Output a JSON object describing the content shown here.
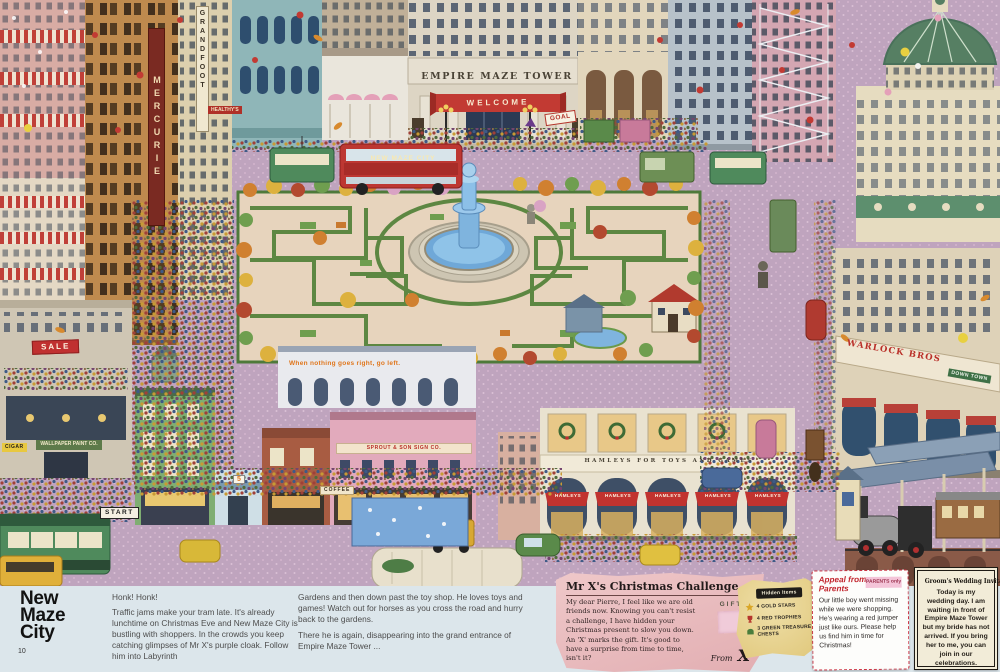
{
  "page": {
    "number": "10",
    "title_lines": [
      "New",
      "Maze",
      "City"
    ]
  },
  "intro": {
    "exclaim": "Honk! Honk!",
    "para1": "Traffic jams make your tram late. It's already lunchtime on Christmas Eve and New Maze City is bustling with shoppers. In the crowds you keep catching glimpses of Mr X's purple cloak. Follow him into Labyrinth",
    "para2": "Gardens and then down past the toy shop. He loves toys and games! Watch out for horses as you cross the road and hurry back to the gardens.",
    "para3": "There he is again, disappearing into the grand entrance of Empire Maze Tower ..."
  },
  "challenge": {
    "title": "Mr X's Christmas Challenge",
    "body": "My dear Pierre, I feel like we are old friends now. Knowing you can't resist a challenge, I have hidden your Christmas present to slow you down. An 'X' marks the gift. It's good to have a surprise from time to time, isn't it?",
    "gift_label": "GIFT",
    "signature_from": "From",
    "signature_x": "X"
  },
  "hidden_items": {
    "title": "Hidden Items",
    "items": [
      {
        "icon": "gold-star",
        "label": "4 GOLD STARS",
        "color": "#d9a627"
      },
      {
        "icon": "red-trophy",
        "label": "4 RED TROPHIES",
        "color": "#b5352c"
      },
      {
        "icon": "green-treasure-chest",
        "label": "3 GREEN TREASURE CHESTS",
        "color": "#4a7d3c"
      }
    ]
  },
  "parents_appeal": {
    "title": "Appeal from Parents",
    "badge": "PARENTS only",
    "body": "Our little boy went missing while we were shopping. He's wearing a red jumper just like ours. Please help us find him in time for Christmas!"
  },
  "wedding_invitation": {
    "title": "Groom's Wedding Invitation",
    "body": "Today is my wedding day. I am waiting in front of Empire Maze Tower but my bride has not arrived. If you bring her to me, you can join in our celebrations."
  },
  "scene": {
    "signs": {
      "tower_name": "EMPIRE MAZE TOWER",
      "welcome": "WELCOME",
      "goal": "GOAL",
      "start": "START",
      "bus": "NEW MAZE CITY",
      "toyshop_frieze": "HAMLEYS FOR TOYS AND GAMES",
      "toyshop_awning": "HAMLEYS",
      "department_store": "WARLOCK BROS",
      "downtown": "DOWN TOWN",
      "sale": "SALE",
      "graffiti": "When nothing goes right, go left.",
      "sign_company": "SPROUT & SON SIGN CO.",
      "coffee": "COFFEE",
      "wallpaper": "WALLPAPER PAINT CO.",
      "cigar": "CIGAR",
      "mercurie": "MERCURIE",
      "grandfoot": "GRANDFOOT",
      "healthys": "HEALTHY'S",
      "shop_number": "5"
    },
    "colors": {
      "street": "#bfa4be",
      "garden_path": "#e7d4bd",
      "hedge": "#5d8742",
      "fountain": "#6fa8d8",
      "tower_facade": "#ddd5c4",
      "banner_red": "#c23a33",
      "toyshop_red": "#c1332f",
      "band_bg": "#dce6eb",
      "letter_pink": "#e7babd",
      "note_yellow": "#e7d194"
    }
  }
}
